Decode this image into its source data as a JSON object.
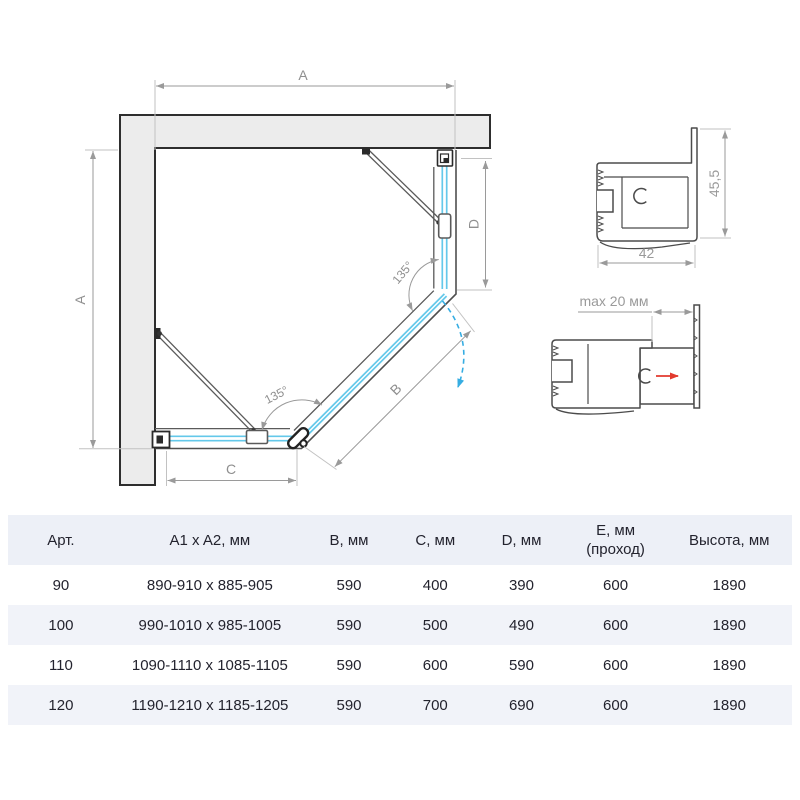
{
  "diagram": {
    "labels": {
      "a_top": "A",
      "a_left": "A",
      "b": "B",
      "c": "C",
      "d": "D",
      "angle_upper": "135°",
      "angle_lower": "135°"
    },
    "profiles": {
      "top": {
        "width_mm": "42",
        "height_mm": "45,5"
      },
      "bottom": {
        "adjustment": "max 20 мм"
      }
    },
    "colors": {
      "glass": "#64c8ea",
      "wall_fill": "#ececec",
      "frame": "#4f4f4f",
      "dimension": "#9a9a9a",
      "swing_arc": "#36ade2",
      "red_arrow": "#e23a2e",
      "table_header_bg": "#edf0f7",
      "table_alt_row_bg": "#f1f3f9"
    }
  },
  "table": {
    "headers": {
      "art": "Арт.",
      "a1a2": "A1 x A2, мм",
      "b": "B, мм",
      "c": "C, мм",
      "d": "D, мм",
      "e_line1": "E, мм",
      "e_line2": "(проход)",
      "height": "Высота, мм"
    },
    "rows": [
      {
        "art": "90",
        "a1a2": "890-910 x 885-905",
        "b": "590",
        "c": "400",
        "d": "390",
        "e": "600",
        "height": "1890"
      },
      {
        "art": "100",
        "a1a2": "990-1010 x 985-1005",
        "b": "590",
        "c": "500",
        "d": "490",
        "e": "600",
        "height": "1890"
      },
      {
        "art": "110",
        "a1a2": "1090-1110 x 1085-1105",
        "b": "590",
        "c": "600",
        "d": "590",
        "e": "600",
        "height": "1890"
      },
      {
        "art": "120",
        "a1a2": "1190-1210 x 1185-1205",
        "b": "590",
        "c": "700",
        "d": "690",
        "e": "600",
        "height": "1890"
      }
    ]
  }
}
